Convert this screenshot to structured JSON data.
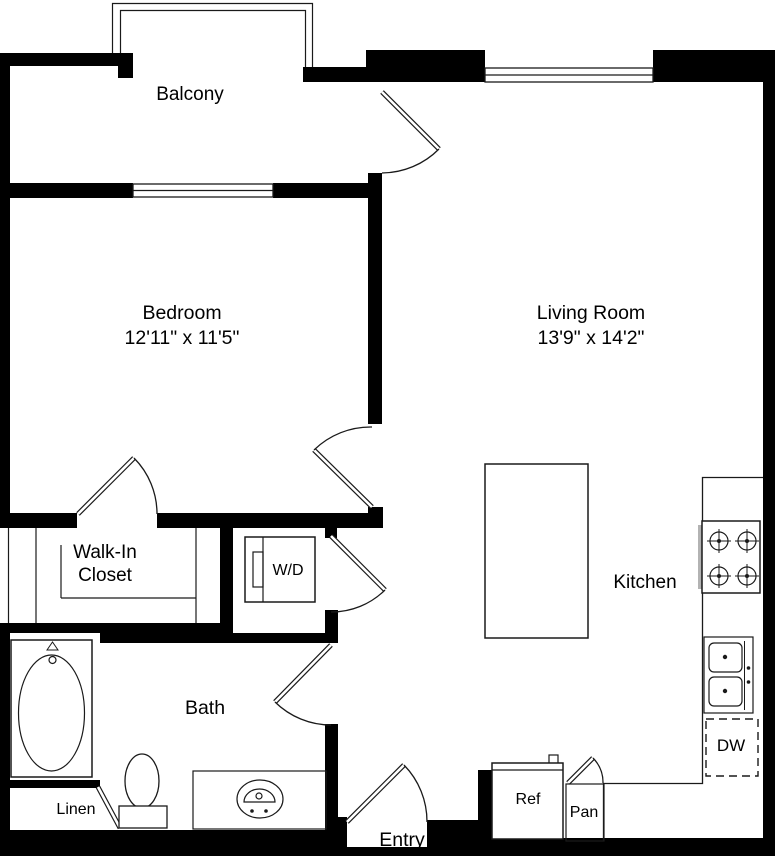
{
  "colors": {
    "wall": "#000000",
    "line": "#1a1a1a",
    "background": "#ffffff"
  },
  "rooms": {
    "balcony": {
      "label": "Balcony"
    },
    "bedroom": {
      "label": "Bedroom",
      "dimensions": "12'11\" x 11'5\""
    },
    "living_room": {
      "label": "Living Room",
      "dimensions": "13'9\" x 14'2\""
    },
    "walk_in_closet": {
      "label_line1": "Walk-In",
      "label_line2": "Closet"
    },
    "kitchen": {
      "label": "Kitchen"
    },
    "bath": {
      "label": "Bath"
    },
    "entry": {
      "label": "Entry"
    }
  },
  "fixtures": {
    "washer_dryer": {
      "label": "W/D"
    },
    "refrigerator": {
      "label": "Ref"
    },
    "pantry": {
      "label": "Pan"
    },
    "dishwasher": {
      "label": "DW"
    },
    "linen_closet": {
      "label": "Linen"
    }
  }
}
